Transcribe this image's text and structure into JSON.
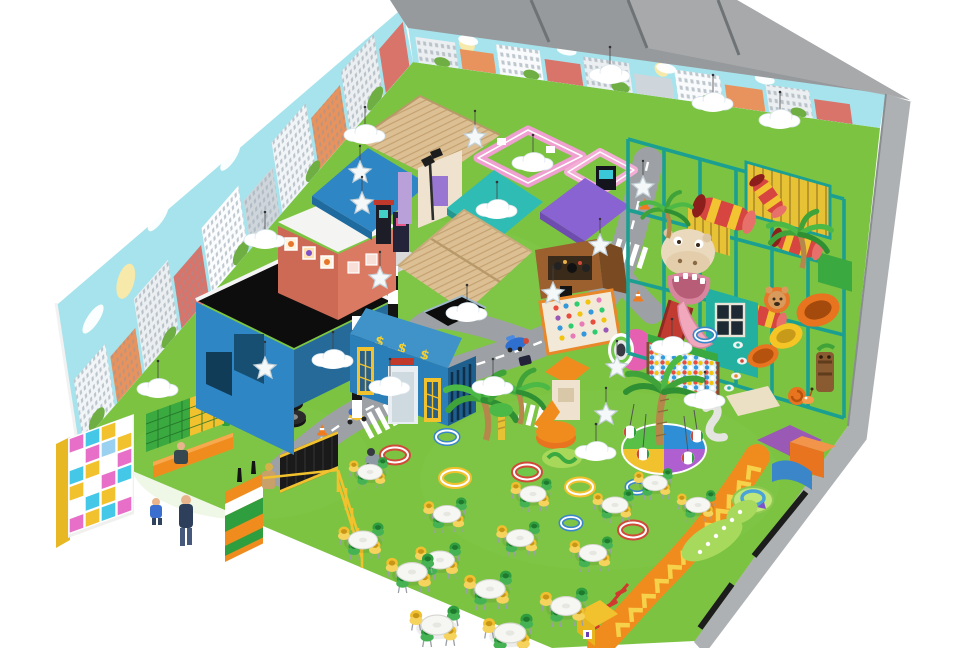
{
  "scene": {
    "type": "indoor-playground-3d-render",
    "view": "isometric overhead",
    "bank_sign": "$ $ $",
    "inventory": {
      "tables": 15,
      "hanging_clouds": 15,
      "hanging_stars": 10,
      "play_rings": 9,
      "party_room_dividers": 3
    },
    "objects": [
      "city-mural-walls",
      "party-rooms",
      "turf-floor",
      "toy-road",
      "crosswalks",
      "bank-building",
      "garage-building",
      "brick-house",
      "blue-awning-shop",
      "wood-roof-canopies",
      "teal-roof-house",
      "purple-roof-kiosk",
      "pink-playhouses",
      "soft-play-structure",
      "hippo-slide",
      "ball-pit",
      "crawl-tubes",
      "palm-trees",
      "toddler-carousel",
      "pink-tunnel",
      "peg-board",
      "orange-track",
      "ring-pool",
      "cafe-tables",
      "cubby-shelves",
      "shoe-shelves",
      "reception-desk",
      "yellow-fence",
      "mesh-fence",
      "visitors",
      "traffic-cones",
      "tire-stack",
      "scooter-toys",
      "tiki-totem",
      "snail-toy",
      "soft-blocks",
      "street-lamp",
      "seesaw-pad"
    ]
  },
  "palette": {
    "grass": "#7cc342",
    "grassLight": "#92d35a",
    "sky": "#a7e3ec",
    "wallGray": "#979a9d",
    "wallGrayLight": "#aeb1b3",
    "road": "#9da1a5",
    "frameTeal": "#1b9f90",
    "awningBlue": "#2e86c5",
    "roofTan": "#dcc094",
    "pinkHouse": "#ef9fd0",
    "tealRoof": "#2fbcb4",
    "purpleRoof": "#8a63d2",
    "kioskBrown": "#9c5f2e",
    "brick": "#cd6a55",
    "bankBlue": "#2b7fb8",
    "bankRoof": "#3f93c9",
    "dollar": "#f5d033",
    "chairGreen": "#2f9e3e",
    "chairYellow": "#f0c030",
    "orange": "#f08c1e",
    "tableWhite": "#f6f6f3",
    "hippoCream": "#ead9bd",
    "slideRed": "#c23b31",
    "palmGreen": "#3fa33a",
    "black": "#141414"
  }
}
